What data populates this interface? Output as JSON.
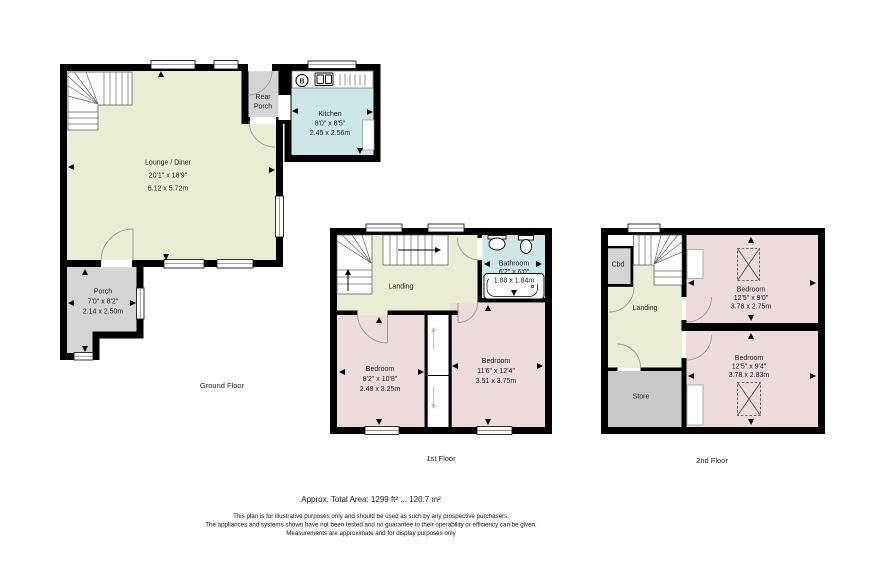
{
  "colors": {
    "wall": "#000000",
    "cream": "#ebecd4",
    "pink": "#eedcdc",
    "blue": "#cde7e8",
    "porch_grey": "#d4d4d4",
    "store_grey": "#c9c9c9"
  },
  "ground_floor": {
    "caption": "Ground Floor",
    "lounge": {
      "name": "Lounge / Diner",
      "imperial": "20'1\" x 18'9\"",
      "metric": "6.12 x 5.72m"
    },
    "kitchen": {
      "name": "Kitchen",
      "imperial": "8'0\" x 8'5\"",
      "metric": "2.45 x 2.56m"
    },
    "rear_porch": {
      "line1": "Rear",
      "line2": "Porch"
    },
    "porch": {
      "name": "Porch",
      "imperial": "7'0\" x 8'2\"",
      "metric": "2.14 x 2.50m"
    },
    "boiler_label": "B"
  },
  "first_floor": {
    "caption": "1st Floor",
    "landing": {
      "name": "Landing"
    },
    "bathroom": {
      "name": "Bathroom",
      "imperial": "6'2\" x 6'0\"",
      "metric": "1.88 x 1.84m"
    },
    "bedroom_left": {
      "name": "Bedroom",
      "imperial": "8'2\" x 10'8\"",
      "metric": "2.48 x 3.25m"
    },
    "bedroom_right": {
      "name": "Bedroom",
      "imperial": "11'6\" x 12'4\"",
      "metric": "3.51 x 3.75m"
    }
  },
  "second_floor": {
    "caption": "2nd Floor",
    "cupboard": {
      "name": "Cbd"
    },
    "landing": {
      "name": "Landing"
    },
    "store": {
      "name": "Store"
    },
    "bedroom_front": {
      "name": "Bedroom",
      "imperial": "12'5\" x 9'0\"",
      "metric": "3.78 x 2.75m"
    },
    "bedroom_rear": {
      "name": "Bedroom",
      "imperial": "12'5\" x 9'4\"",
      "metric": "3.78 x 2.83m"
    }
  },
  "footer": {
    "total_area": "Approx. Total Area: 1299 ft² ... 120.7 m²",
    "disclaimer_line1": "This plan is for illustrative purposes only and should be used as such by any prospective purchasers.",
    "disclaimer_line2": "The appliances and systems shown have not been tested and no guarantee to their operability or efficiency can be given.",
    "disclaimer_line3": "Measurements are approximate and for display purposes only"
  }
}
